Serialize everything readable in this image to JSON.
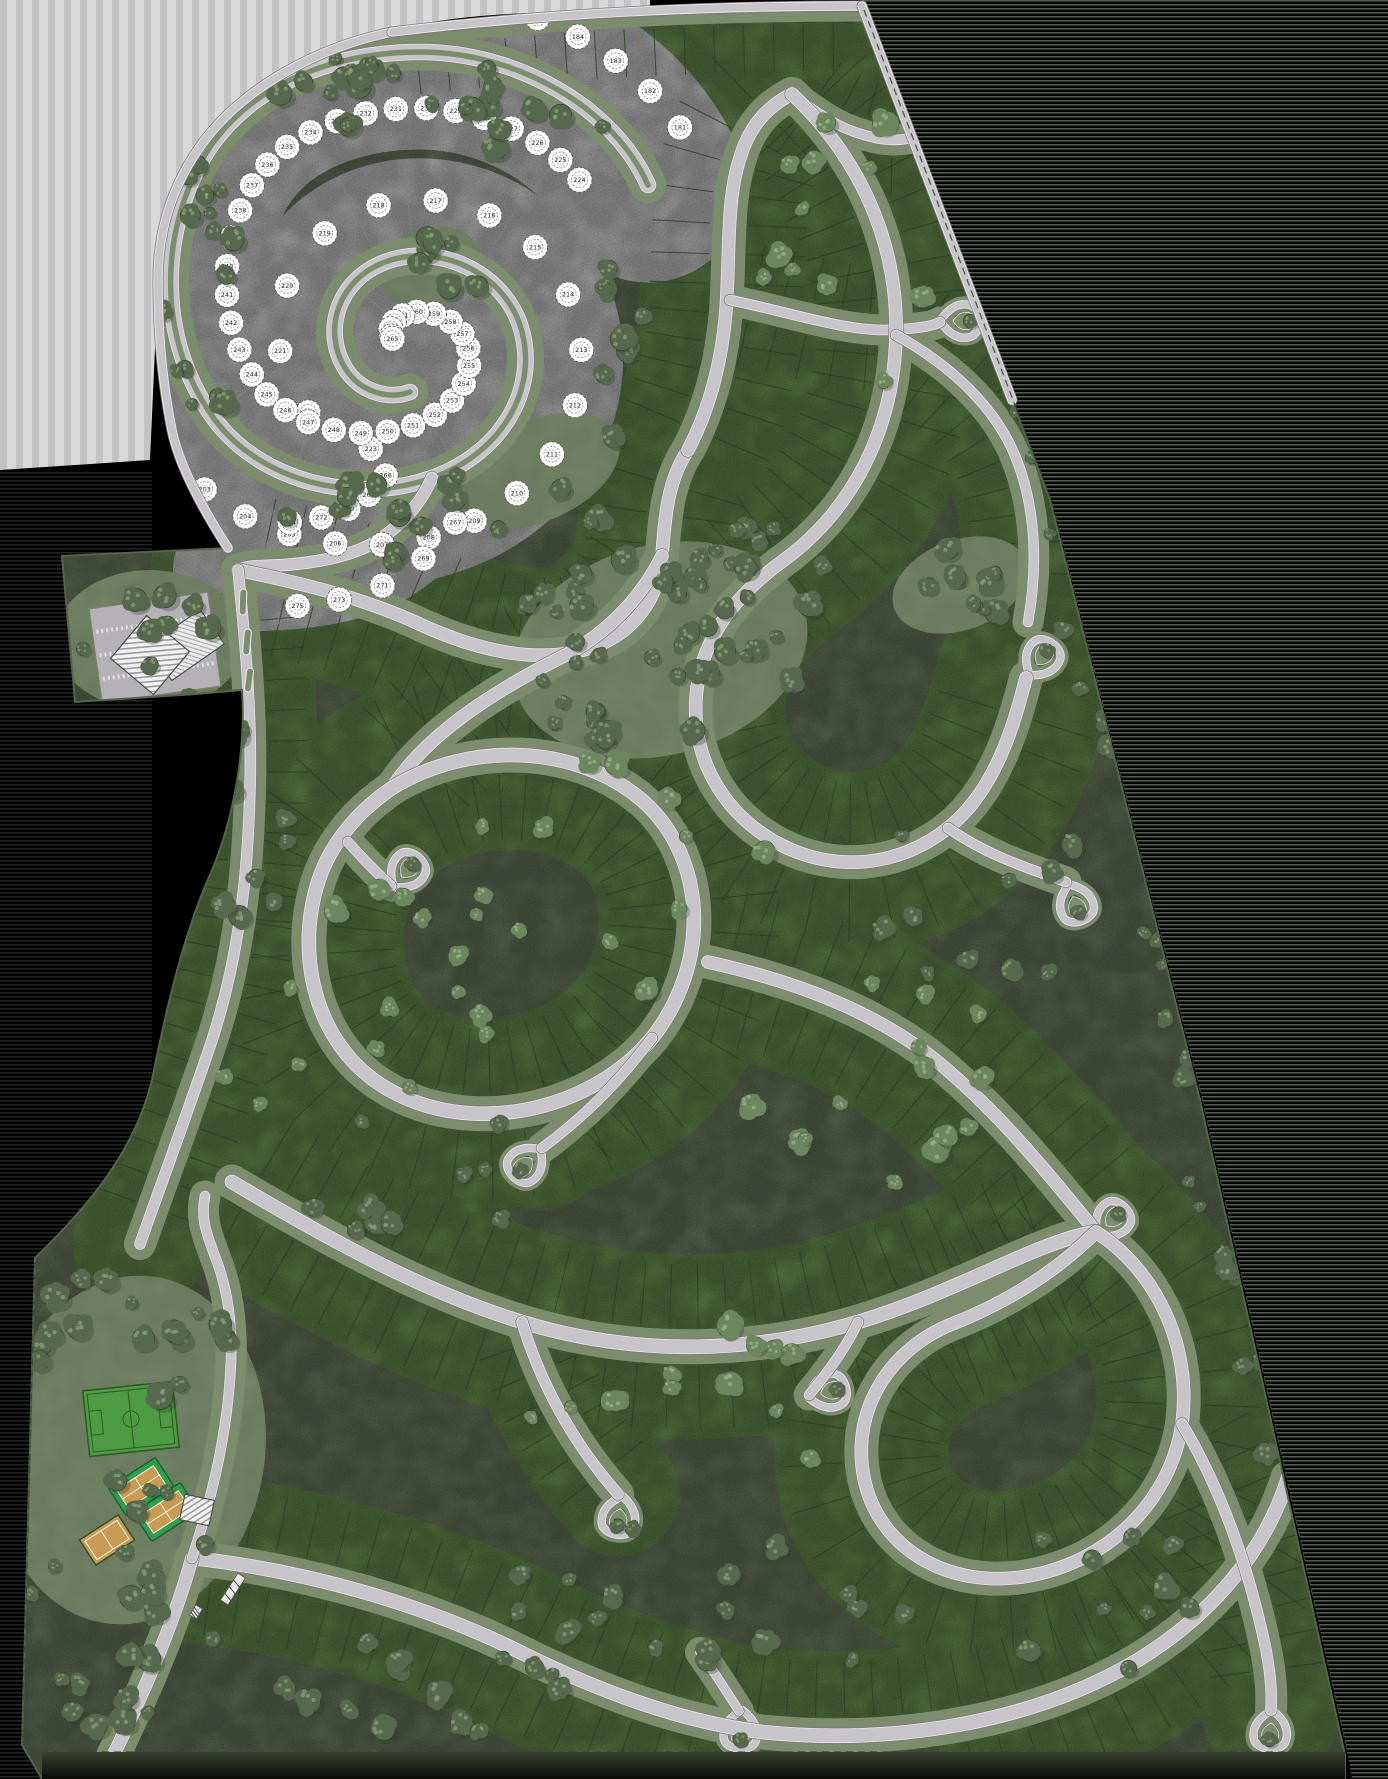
{
  "meta": {
    "kind": "residential-master-plan-site-map"
  },
  "canvas": {
    "width": 1388,
    "height": 1779,
    "background": "#000000"
  },
  "palette": {
    "outside": "#000000",
    "smear_light": "#d9d9d9",
    "smear_stripe": "#c3c3c3",
    "edge_stripe": "#93a08e",
    "terrain_sage": "#7b8d6d",
    "lot_green": "#79a25b",
    "lot_texture_light": "#8fb271",
    "lot_texture_dark": "#3c5a30",
    "lot_line": "#31482a",
    "road_edge": "#7e7c77",
    "road_curb": "#e8e8ea",
    "road_fill": "#c7c4ca",
    "median_sage": "#7b8d6d",
    "plat_white": "#e9e9e9",
    "plat_line": "#8f8f8f",
    "sketch_tree_fill": "#fdfdfd",
    "sketch_tree_stroke": "#5f5f5f",
    "tree_dark_base": "#56684d",
    "tree_dark_edge": "#39462f",
    "tree_dark_hi": "#8ba178",
    "tree_light_base": "#6d8660",
    "tree_light_edge": "#4a5c40",
    "tree_light_hi": "#9eb489",
    "tree_shadow": "#2e3b28",
    "field_green": "#4d9b43",
    "field_line": "#2c5c26",
    "court_pad_green": "#2f9e4e",
    "court_clay": "#c89a52",
    "court_line": "#ffffff",
    "building_white": "#f2f2f2",
    "building_stroke": "#4a4a4a",
    "hatch_gray": "#9a9a9a",
    "asphalt": "#b4b1b7",
    "dash_line": "#39472f",
    "boundary_stroke": "#55644c",
    "bottom_strip_top": "#39402f",
    "bottom_strip_bottom": "#0a0b0a"
  },
  "site": {
    "boundary_d": "M 392 32 C 540 14 700 6 862 6 L 1050 500 L 1200 1100 L 1345 1755 L 1345 1779 L 42 1779 L 22 1745 L 35 1258 C 90 1205 135 1150 152 1080 C 168 1000 185 930 212 870 C 235 815 246 745 242 690 L 196 694 L 75 702 L 62 556 L 228 548 C 210 520 180 470 172 430 C 162 380 158 330 158 280 C 158 225 175 180 205 140 C 245 88 315 48 392 32 Z",
    "perimeter_road_ds": [
      "M 392 32 C 315 48 245 88 205 140 C 175 180 158 225 158 280 C 158 330 162 380 172 430 C 180 470 210 520 228 548",
      "M 392 32 C 540 14 700 6 862 6",
      "M 862 6 L 1012 400"
    ],
    "property_dash_ds": [
      "M 864 10 L 1052 502 L 1203 1102 L 1348 1754",
      "M 42 1752 L 1340 1752",
      "M 35 1262 L 22 1740"
    ],
    "bottom_strip_d": "M 42 1752 L 1345 1752 L 1345 1779 L 42 1779 Z"
  },
  "artifacts": {
    "tl_smear_d": "M 0 0 L 650 0 L 650 14 C 520 8 430 18 392 32 C 312 50 244 92 204 142 C 174 180 158 226 158 282 L 150 460 L 0 470 Z",
    "right_stripes_d": "M 862 0 L 1388 0 L 1388 1779 L 1352 1779 L 1348 1756 L 1203 1102 L 1052 502 L 864 6 Z",
    "left_stripes": {
      "x": 0,
      "y": 470,
      "w": 152,
      "h": 1309
    }
  },
  "white_plat": {
    "number_start": 181,
    "spiral_d": "M 648 185 C 615 110 520 52 420 52 C 320 52 225 95 190 185 C 158 262 165 352 215 420 C 262 482 355 505 432 478 C 505 452 540 385 520 325 C 502 272 438 242 385 262 C 338 280 322 330 345 368 C 360 392 388 400 410 392",
    "spiral_band": 195,
    "tail_d": "M 432 478 C 420 505 400 528 370 545 C 340 560 300 565 262 566 C 250 566 244 568 238 570",
    "tail_band": 130,
    "tick_step": 34,
    "tree_step": 37,
    "spiral_rail_offset": 56,
    "tail_rail_offset": 42,
    "center_blob": {
      "cx": 430,
      "cy": 268,
      "rx": 52,
      "ry": 40,
      "rot": -20
    }
  },
  "roads": [
    {
      "id": "top-boundary",
      "d": "M 392 32 C 540 14 700 6 862 6",
      "w": 9,
      "band": 150,
      "corridor": true
    },
    {
      "id": "spiral-blvd",
      "d": "M 648 185 C 615 110 520 52 420 52 C 320 52 225 95 190 185 C 158 262 165 352 215 420 C 262 482 355 505 432 478 C 505 452 540 385 520 325 C 502 272 438 242 385 262 C 338 280 322 330 345 368 C 360 392 388 400 410 392",
      "w": 15,
      "band": 0,
      "corridor": true,
      "median": true
    },
    {
      "id": "plat-tail",
      "d": "M 432 478 C 420 505 400 528 370 545 C 340 560 300 565 262 566 C 250 566 244 568 238 570",
      "w": 11,
      "band": 0,
      "corridor": true
    },
    {
      "id": "collector-1",
      "d": "M 238 570 C 300 583 360 597 415 622 C 470 648 525 662 575 652 C 625 642 658 607 662 556 C 665 515 668 480 688 450",
      "w": 12,
      "band": 175,
      "corridor": true
    },
    {
      "id": "collector-2",
      "d": "M 688 450 C 710 408 722 360 726 310 C 730 255 726 200 740 158 C 748 130 764 108 792 94",
      "w": 12,
      "band": 175,
      "corridor": true
    },
    {
      "id": "ne-spur",
      "d": "M 792 94 C 822 118 846 132 876 138 C 910 145 938 132 952 108",
      "w": 9,
      "band": 130,
      "corridor": true
    },
    {
      "id": "mid-spur",
      "d": "M 730 300 C 788 312 842 330 884 330 C 912 329 932 327 940 322",
      "w": 9,
      "band": 145,
      "corridor": true
    },
    {
      "id": "right-loop",
      "d": "M 792 94 C 862 160 898 245 896 335 C 894 430 852 510 784 560 C 734 596 700 640 696 698 C 692 758 722 810 772 840 C 830 874 898 868 948 828 C 996 790 1014 724 1026 678",
      "w": 12,
      "band": 180,
      "corridor": true
    },
    {
      "id": "right-arc",
      "d": "M 896 335 C 952 366 996 408 1016 458 C 1036 508 1038 566 1028 622",
      "w": 9,
      "band": 145,
      "corridor": true
    },
    {
      "id": "center-link",
      "d": "M 662 556 C 640 600 604 636 560 658 C 488 694 424 738 392 788",
      "w": 12,
      "band": 165,
      "corridor": true
    },
    {
      "id": "big-loop",
      "d": "M 392 788 C 470 740 578 744 644 802 C 706 858 712 962 652 1038 C 590 1112 470 1138 386 1088 C 302 1038 292 924 330 854 C 346 826 366 806 392 788 Z",
      "w": 13,
      "band": 190,
      "corridor": true
    },
    {
      "id": "loop-spur-n",
      "d": "M 348 842 C 362 858 376 872 391 886",
      "w": 9,
      "band": 0,
      "corridor": true
    },
    {
      "id": "loop-spur-se",
      "d": "M 652 1038 C 616 1086 580 1120 542 1148",
      "w": 9,
      "band": 125,
      "corridor": true
    },
    {
      "id": "east-link",
      "d": "M 708 962 C 798 982 876 1012 938 1062 C 998 1112 1044 1168 1096 1232",
      "w": 12,
      "band": 175,
      "corridor": true
    },
    {
      "id": "east-spur",
      "d": "M 948 828 C 988 856 1028 868 1066 882",
      "w": 9,
      "band": 0,
      "corridor": true
    },
    {
      "id": "mid-sweep",
      "d": "M 232 1182 C 330 1240 424 1292 522 1322 C 640 1358 758 1352 858 1322 C 958 1292 1040 1240 1096 1232",
      "w": 13,
      "band": 185,
      "corridor": true
    },
    {
      "id": "south-collector",
      "d": "M 192 1558 C 300 1570 420 1602 520 1652 C 600 1692 682 1722 762 1732 C 900 1746 1038 1720 1138 1660 C 1216 1612 1266 1548 1288 1478",
      "w": 13,
      "band": 170,
      "corridor": true
    },
    {
      "id": "gate-entry",
      "d": "M 112 1758 C 148 1684 176 1616 192 1558",
      "w": 12,
      "band": 0,
      "corridor": true
    },
    {
      "id": "south-spur-1",
      "d": "M 522 1322 C 540 1382 572 1442 618 1494",
      "w": 10,
      "band": 125,
      "corridor": true
    },
    {
      "id": "south-spur-2",
      "d": "M 858 1322 C 846 1348 828 1372 809 1395",
      "w": 9,
      "band": 115,
      "corridor": true
    },
    {
      "id": "south-spur-3",
      "d": "M 700 1652 C 714 1672 727 1692 739 1711",
      "w": 8,
      "band": 0,
      "corridor": true
    },
    {
      "id": "se-loop",
      "d": "M 1096 1232 C 1158 1272 1192 1348 1182 1424 C 1170 1502 1108 1562 1028 1576 C 948 1590 878 1548 864 1478 C 850 1408 892 1348 952 1324 C 1004 1304 1056 1272 1096 1232 Z",
      "w": 12,
      "band": 175,
      "corridor": true
    },
    {
      "id": "se-spur",
      "d": "M 1182 1424 C 1222 1490 1250 1572 1266 1650 C 1271 1676 1272 1694 1271 1710",
      "w": 10,
      "band": 140,
      "corridor": true
    },
    {
      "id": "west-perimeter",
      "d": "M 238 570 C 246 648 252 720 250 788 C 248 878 238 968 206 1058 C 184 1122 162 1182 140 1244",
      "w": 10,
      "band": 135,
      "corridor": true
    },
    {
      "id": "sports-drive",
      "d": "M 192 1558 C 212 1498 226 1438 230 1378 C 234 1330 228 1288 214 1254 C 208 1236 200 1220 205 1196",
      "w": 9,
      "band": 0,
      "corridor": true
    }
  ],
  "tick_style": {
    "step": 30,
    "inner_pad": 13,
    "outer_pad": 10,
    "width": 1.1,
    "opacity": 0.8
  },
  "teardrops": [
    {
      "x": 958,
      "y": 98,
      "rot": 70
    },
    {
      "x": 944,
      "y": 321,
      "rot": 90
    },
    {
      "x": 1032,
      "y": 672,
      "rot": 35
    },
    {
      "x": 396,
      "y": 884,
      "rot": 40
    },
    {
      "x": 538,
      "y": 1152,
      "rot": 225
    },
    {
      "x": 1070,
      "y": 888,
      "rot": 160
    },
    {
      "x": 622,
      "y": 1500,
      "rot": 190
    },
    {
      "x": 812,
      "y": 1396,
      "rot": 75
    },
    {
      "x": 742,
      "y": 1714,
      "rot": 185
    },
    {
      "x": 1272,
      "y": 1714,
      "rot": 185
    },
    {
      "x": 1100,
      "y": 1232,
      "rot": 45
    }
  ],
  "entry_islands": [
    {
      "x": 243,
      "y": 602,
      "rot": 92,
      "w": 26,
      "h": 7
    },
    {
      "x": 247,
      "y": 642,
      "rot": 95,
      "w": 26,
      "h": 7
    },
    {
      "x": 249,
      "y": 680,
      "rot": 97,
      "w": 24,
      "h": 7
    }
  ],
  "commons": [
    {
      "cx": 660,
      "cy": 650,
      "rx": 150,
      "ry": 105,
      "rot": -15
    },
    {
      "cx": 540,
      "cy": 470,
      "rx": 85,
      "ry": 50,
      "rot": -25
    },
    {
      "cx": 960,
      "cy": 585,
      "rx": 70,
      "ry": 45,
      "rot": -20
    },
    {
      "cx": 150,
      "cy": 640,
      "rx": 95,
      "ry": 70,
      "rot": 0
    },
    {
      "cx": 130,
      "cy": 1450,
      "rx": 135,
      "ry": 175,
      "rot": 8
    },
    {
      "cx": 430,
      "cy": 268,
      "rx": 52,
      "ry": 40,
      "rot": -20
    }
  ],
  "amenities": {
    "parking_lot": {
      "x": 95,
      "y": 600,
      "w": 120,
      "h": 95,
      "rot": -8
    },
    "clubhouse_a": {
      "cx": 150,
      "cy": 655,
      "size": 56,
      "rot": 40
    },
    "clubhouse_b": {
      "cx": 186,
      "cy": 645,
      "w": 64,
      "h": 42,
      "rot": -35
    },
    "soccer_field": {
      "x": 86,
      "y": 1386,
      "w": 90,
      "h": 66,
      "rot": -6
    },
    "tennis_courts": [
      {
        "cx": 141,
        "cy": 1487,
        "w": 56,
        "h": 34,
        "rot": -33
      },
      {
        "cx": 166,
        "cy": 1512,
        "w": 56,
        "h": 34,
        "rot": -33
      }
    ],
    "multi_court": {
      "cx": 107,
      "cy": 1540,
      "w": 46,
      "h": 30,
      "rot": -33
    },
    "sports_building": {
      "cx": 197,
      "cy": 1510,
      "w": 30,
      "h": 26,
      "rot": 12
    },
    "entry_gate": {
      "cx": 233,
      "cy": 1589,
      "w": 32,
      "h": 9,
      "rot": -57
    },
    "guard_house": {
      "cx": 196,
      "cy": 1612,
      "w": 12,
      "h": 8,
      "rot": -57
    }
  },
  "tree_clusters": [
    {
      "cx": 330,
      "cy": 88,
      "rx": 210,
      "ry": 46,
      "n": 24,
      "shade": "dark"
    },
    {
      "cx": 185,
      "cy": 300,
      "rx": 55,
      "ry": 150,
      "n": 16,
      "shade": "dark"
    },
    {
      "cx": 430,
      "cy": 268,
      "rx": 55,
      "ry": 40,
      "n": 7,
      "shade": "dark"
    },
    {
      "cx": 530,
      "cy": 120,
      "rx": 80,
      "ry": 40,
      "n": 8,
      "shade": "dark"
    },
    {
      "cx": 450,
      "cy": 520,
      "rx": 170,
      "ry": 48,
      "n": 18,
      "shade": "dark"
    },
    {
      "cx": 610,
      "cy": 350,
      "rx": 55,
      "ry": 90,
      "n": 8,
      "shade": "dark"
    },
    {
      "cx": 150,
      "cy": 640,
      "rx": 90,
      "ry": 62,
      "n": 9,
      "shade": "dark"
    },
    {
      "cx": 660,
      "cy": 650,
      "rx": 150,
      "ry": 105,
      "n": 42,
      "shade": "dark"
    },
    {
      "cx": 790,
      "cy": 560,
      "rx": 80,
      "ry": 50,
      "n": 10,
      "shade": "dark"
    },
    {
      "cx": 960,
      "cy": 585,
      "rx": 70,
      "ry": 45,
      "n": 9,
      "shade": "dark"
    },
    {
      "cx": 560,
      "cy": 900,
      "rx": 220,
      "ry": 160,
      "n": 16,
      "shade": "light"
    },
    {
      "cx": 350,
      "cy": 1020,
      "rx": 140,
      "ry": 140,
      "n": 12,
      "shade": "light"
    },
    {
      "cx": 130,
      "cy": 1350,
      "rx": 110,
      "ry": 120,
      "n": 16,
      "shade": "dark"
    },
    {
      "cx": 120,
      "cy": 1600,
      "rx": 100,
      "ry": 130,
      "n": 22,
      "shade": "dark"
    },
    {
      "cx": 420,
      "cy": 1180,
      "rx": 120,
      "ry": 80,
      "n": 10,
      "shade": "dark"
    },
    {
      "cx": 680,
      "cy": 1600,
      "rx": 260,
      "ry": 90,
      "n": 20,
      "shade": "dark"
    },
    {
      "cx": 420,
      "cy": 1680,
      "rx": 150,
      "ry": 60,
      "n": 12,
      "shade": "dark"
    },
    {
      "cx": 900,
      "cy": 1100,
      "rx": 180,
      "ry": 120,
      "n": 14,
      "shade": "light"
    },
    {
      "cx": 850,
      "cy": 250,
      "rx": 120,
      "ry": 140,
      "n": 12,
      "shade": "light"
    },
    {
      "cx": 980,
      "cy": 900,
      "rx": 120,
      "ry": 90,
      "n": 10,
      "shade": "dark"
    },
    {
      "cx": 250,
      "cy": 840,
      "rx": 60,
      "ry": 120,
      "n": 10,
      "shade": "dark"
    },
    {
      "cx": 700,
      "cy": 1400,
      "rx": 200,
      "ry": 80,
      "n": 12,
      "shade": "light"
    },
    {
      "cx": 1100,
      "cy": 1600,
      "rx": 120,
      "ry": 80,
      "n": 10,
      "shade": "dark"
    }
  ],
  "tree_lines": [
    {
      "x1": 1010,
      "y1": 300,
      "x2": 1290,
      "y2": 1500,
      "n": 30,
      "spread": 28,
      "shade": "dark"
    }
  ]
}
